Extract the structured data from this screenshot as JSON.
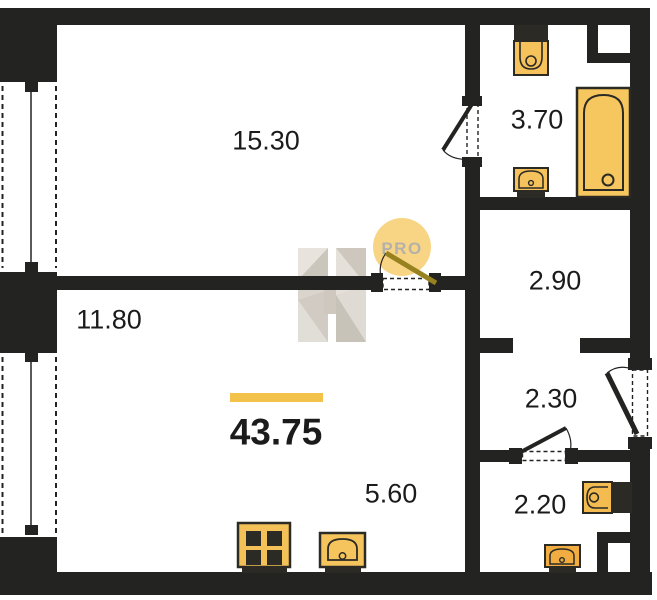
{
  "plan": {
    "title": "apartment-floor-plan",
    "total_area": "43.75",
    "rooms": [
      {
        "name": "living-room",
        "area": "15.30"
      },
      {
        "name": "bathroom",
        "area": "3.70"
      },
      {
        "name": "hall-upper",
        "area": "2.90"
      },
      {
        "name": "bedroom-zone",
        "area": "11.80"
      },
      {
        "name": "entry-hall",
        "area": "2.30"
      },
      {
        "name": "wc",
        "area": "2.20"
      },
      {
        "name": "kitchen-zone",
        "area": "5.60"
      }
    ]
  },
  "watermark": {
    "badge_text": "PRO"
  },
  "colors": {
    "wall": "#232321",
    "fixture_yellow": "#f5c35e",
    "fixture_dark": "#2b2a25",
    "accent_line": "#f2c24b",
    "badge_bg": "#f8d584",
    "badge_text": "#b4b1ab",
    "door_leaf_accent": "#97821f"
  }
}
